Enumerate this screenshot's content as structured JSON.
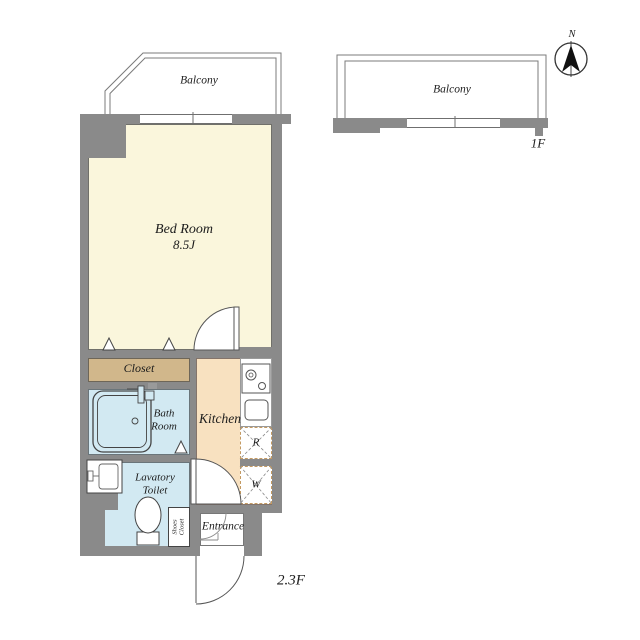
{
  "colors": {
    "wall": "#8a8a8a",
    "bedroom": "#faf6dc",
    "closet": "#d1b78b",
    "bath": "#d2e9f2",
    "kitchen": "#f8e1c0",
    "line": "#555555",
    "accentDash": "#c49a62"
  },
  "compass": {
    "north_label": "N"
  },
  "plan": {
    "floor_label_main": "2.3F",
    "floor_label_sub": "1F",
    "rooms": {
      "balcony_main": "Balcony",
      "balcony_sub": "Balcony",
      "bedroom_name": "Bed Room",
      "bedroom_size": "8.5J",
      "closet": "Closet",
      "bath_line1": "Bath",
      "bath_line2": "Room",
      "kitchen": "Kitchen",
      "lavatory_line1": "Lavatory",
      "lavatory_line2": "Toilet",
      "entrance": "Entrance",
      "shoes_line1": "Shoes",
      "shoes_line2": "Closet",
      "fridge_mark": "R",
      "washer_mark": "W"
    }
  }
}
